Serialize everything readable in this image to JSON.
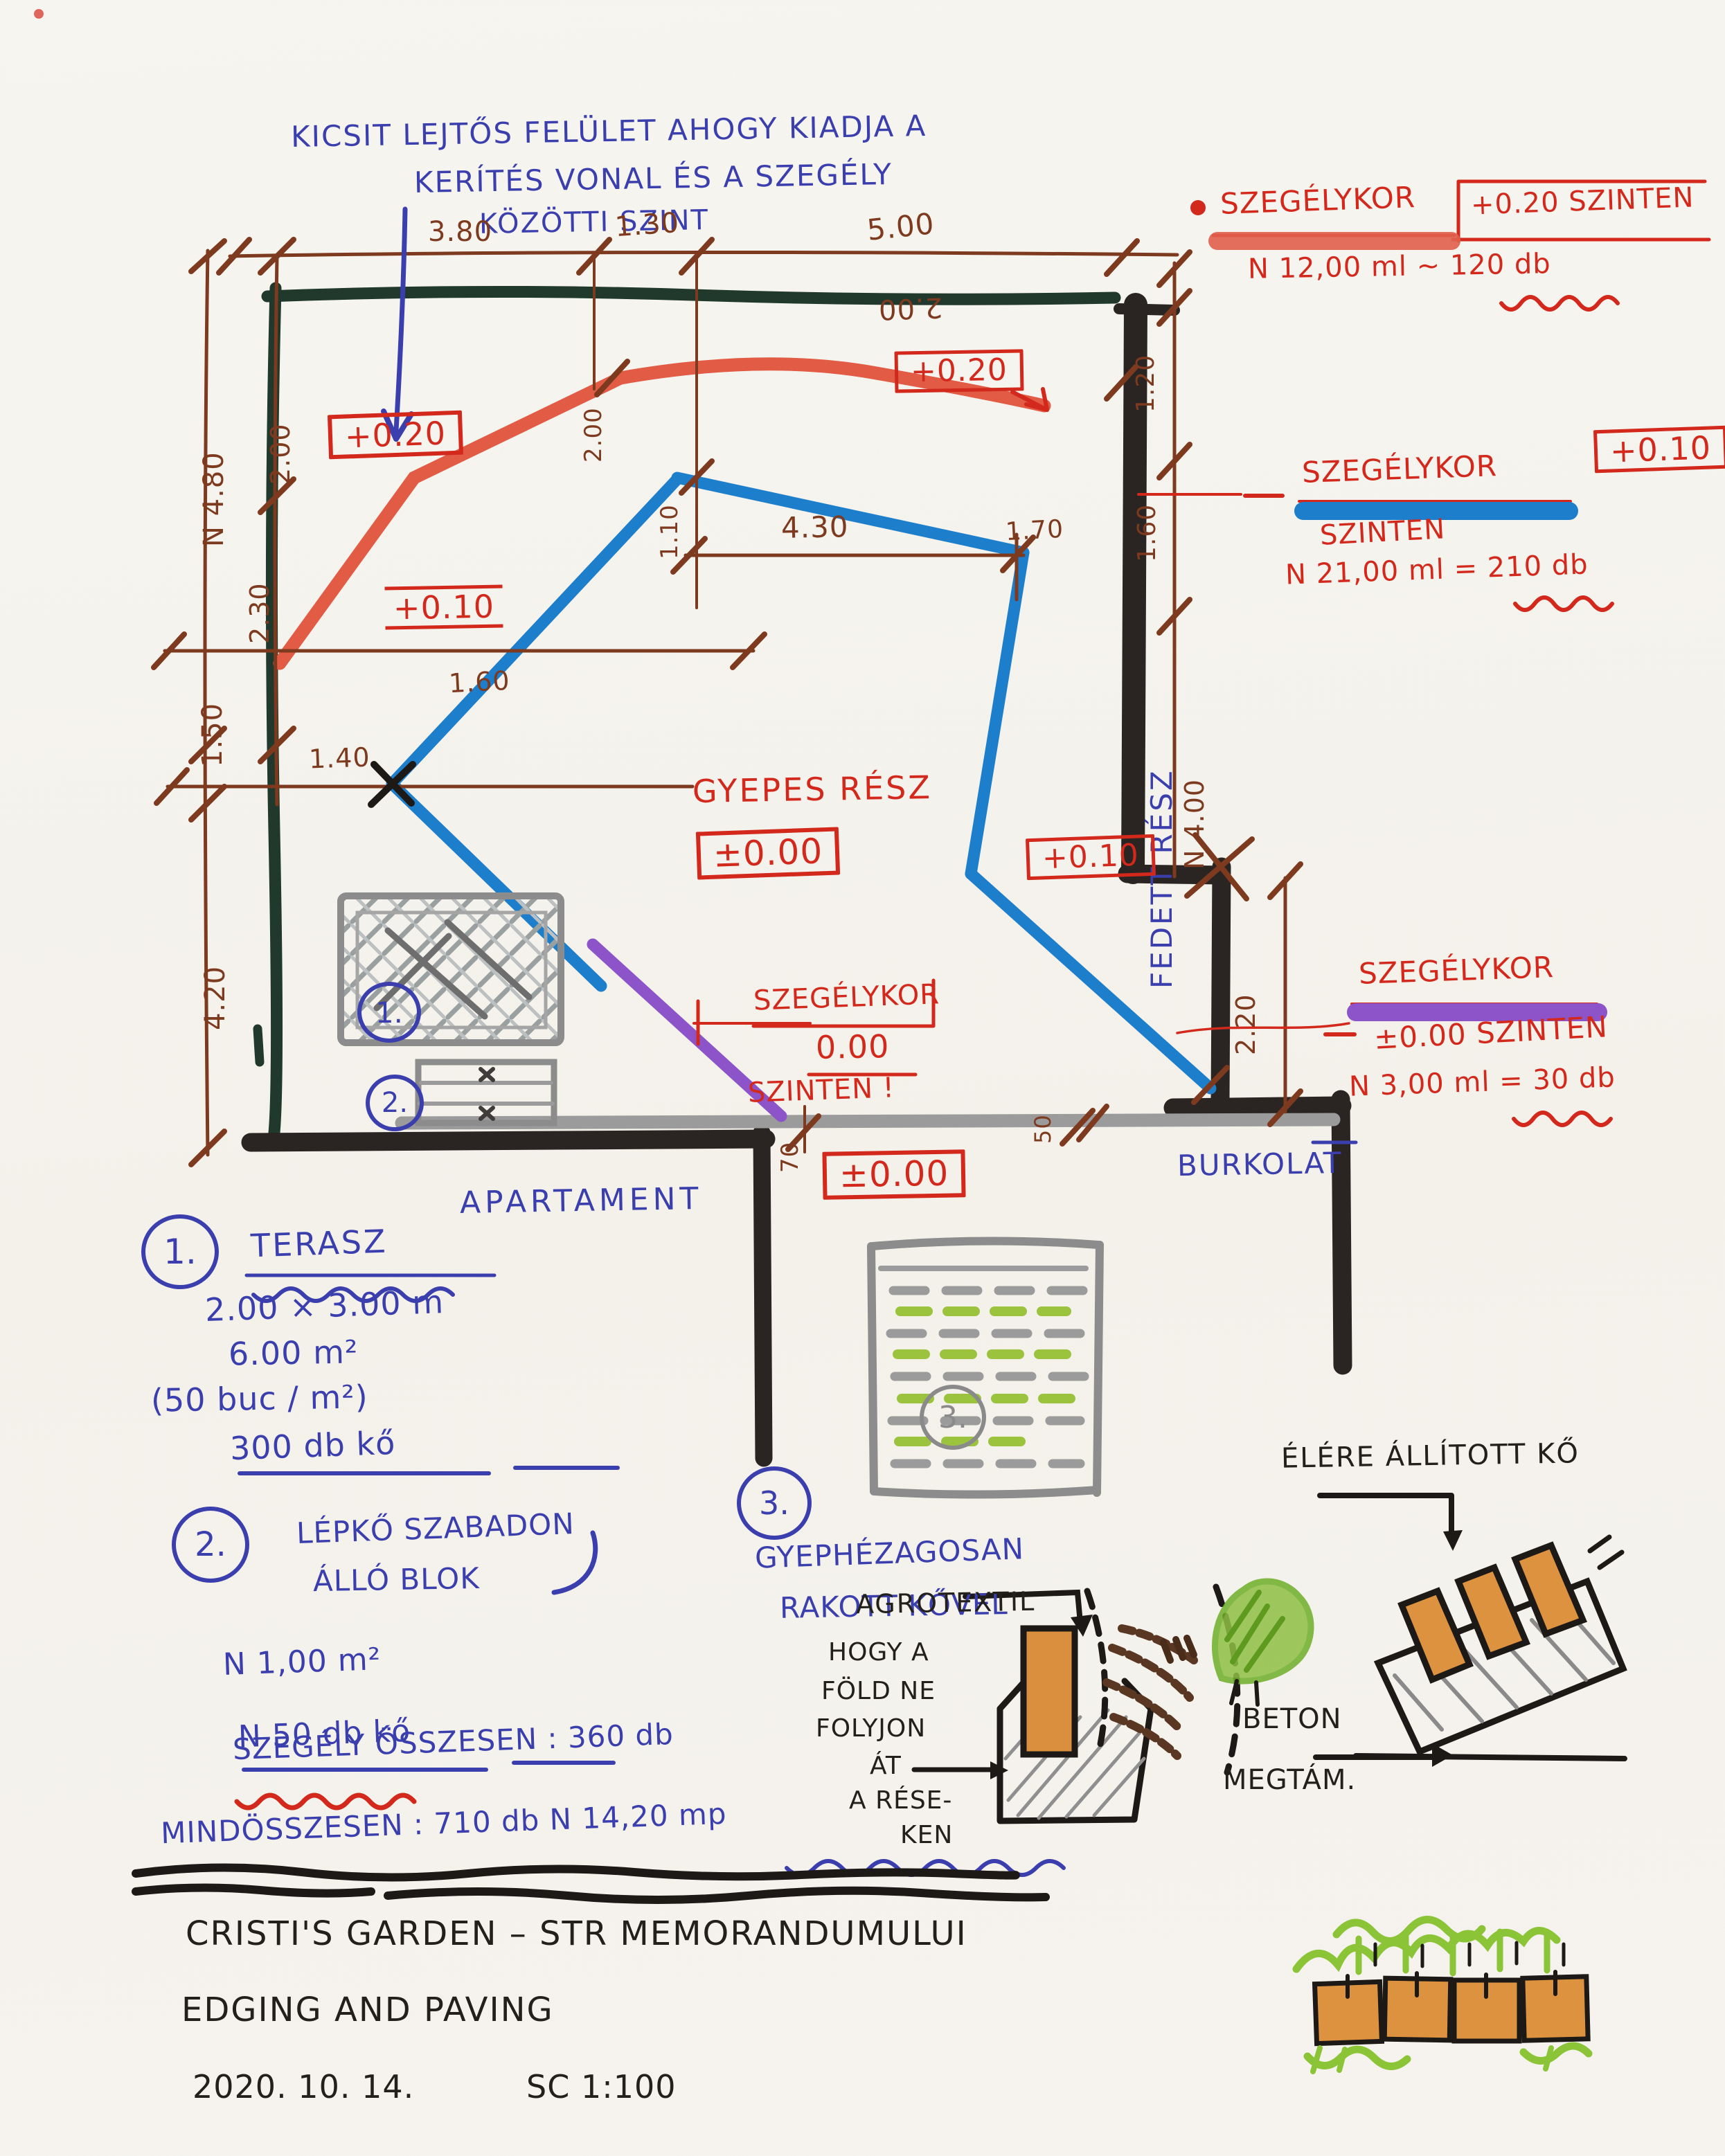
{
  "header_note": {
    "line1": "KICSIT LEJTŐS FELÜLET AHOGY KIADJA A",
    "line2": "KERÍTÉS VONAL ÉS A SZEGÉLY",
    "line3": "KÖZÖTTI SZINT"
  },
  "legend": {
    "top": {
      "label": "SZEGÉLYKOR",
      "level": "+0.20 SZINTEN",
      "qty": "N 12,00 ml ~ 120 db"
    },
    "mid": {
      "label": "SZEGÉLYKOR",
      "box": "+0.10",
      "level": "SZINTEN",
      "qty": "N 21,00 ml = 210 db"
    },
    "low": {
      "label": "SZEGÉLYKOR",
      "level": "±0.00 SZINTEN",
      "qty": "N 3,00 ml = 30 db"
    }
  },
  "plan": {
    "area_labels": {
      "gyepes": "GYEPES RÉSZ",
      "gyepes_level": "±0.00",
      "fedett": "FEDETT RÉSZ",
      "apartament": "APARTAMENT",
      "burkolat": "BURKOLAT"
    },
    "level_boxes": {
      "left_upper": "+0.20",
      "left_lower": "+0.10",
      "top_right": "+0.20",
      "right": "+0.10",
      "bottom": "±0.00"
    },
    "mid_note": {
      "l1": "SZEGÉLYKOR",
      "l2": "0.00",
      "l3": "SZINTEN !"
    },
    "dims": {
      "top_1": "3.80",
      "top_2": "1.30",
      "top_3": "5.00",
      "top_flipped": "2.00",
      "left_outer_1": "N 4.80",
      "left_outer_2": "1.50",
      "left_outer_3": "4.20",
      "left_inner_1": "2.00",
      "left_inner_2": "2.30",
      "h_1": "1.60",
      "h_2": "1.40",
      "h_3": "4.30",
      "v_1": "1.10",
      "v_2": "2.00",
      "diag": "1.70",
      "right_1": "1.20",
      "right_2": "1.60",
      "right_3": "N 4.00",
      "right_4": "2.20",
      "small_1": "70",
      "small_2": "50"
    }
  },
  "notes": {
    "n1": {
      "num": "1.",
      "title": "TERASZ",
      "l1": "2.00 × 3.00 m",
      "l2": "6.00 m²",
      "l3": "(50 buc / m²)",
      "l4": "300 db kő"
    },
    "n2": {
      "num": "2.",
      "l1": "LÉPKŐ SZABADON",
      "l2": "ÁLLÓ BLOK",
      "l3": "N 1,00 m²",
      "l4": "N 50 db kő"
    },
    "n3": {
      "num": "3.",
      "l1": "GYEPHÉZAGOSAN",
      "l2": "RAKOTT KŐVEL",
      "area_num": "3."
    },
    "totals": {
      "l1": "SZEGÉLY ÖSSZESEN : 360 db",
      "l2": "MINDÖSSZESEN : 710 db   N   14,20 mp"
    }
  },
  "details": {
    "agrotextil": {
      "title": "AGROTEXTIL",
      "c1": "HOGY A",
      "c2": "FÖLD NE",
      "c3": "FOLYJON",
      "c4": "ÁT",
      "c5": "A RÉSE-",
      "c6": "KEN"
    },
    "edge": {
      "title": "ÉLÉRE ÁLLÍTOTT KŐ",
      "beton1": "BETON",
      "beton2": "MEGTÁM."
    }
  },
  "titleblock": {
    "l1": "CRISTI'S GARDEN  –  STR MEMORANDUMULUI",
    "l2": "EDGING AND PAVING",
    "date": "2020. 10. 14.",
    "scale": "SC 1:100"
  },
  "colors": {
    "red_pen": "#d3291d",
    "blue_pen": "#3b3fae",
    "brown_pen": "#7d3a1f",
    "red_marker": "#e25b45",
    "blue_marker": "#1d7ecb",
    "purple_marker": "#8c54c8",
    "green_fence": "#20392c",
    "black_marker": "#2a2522",
    "gray_marker": "#9b9b9b",
    "orange": "#dd923f",
    "green": "#8bc437"
  }
}
